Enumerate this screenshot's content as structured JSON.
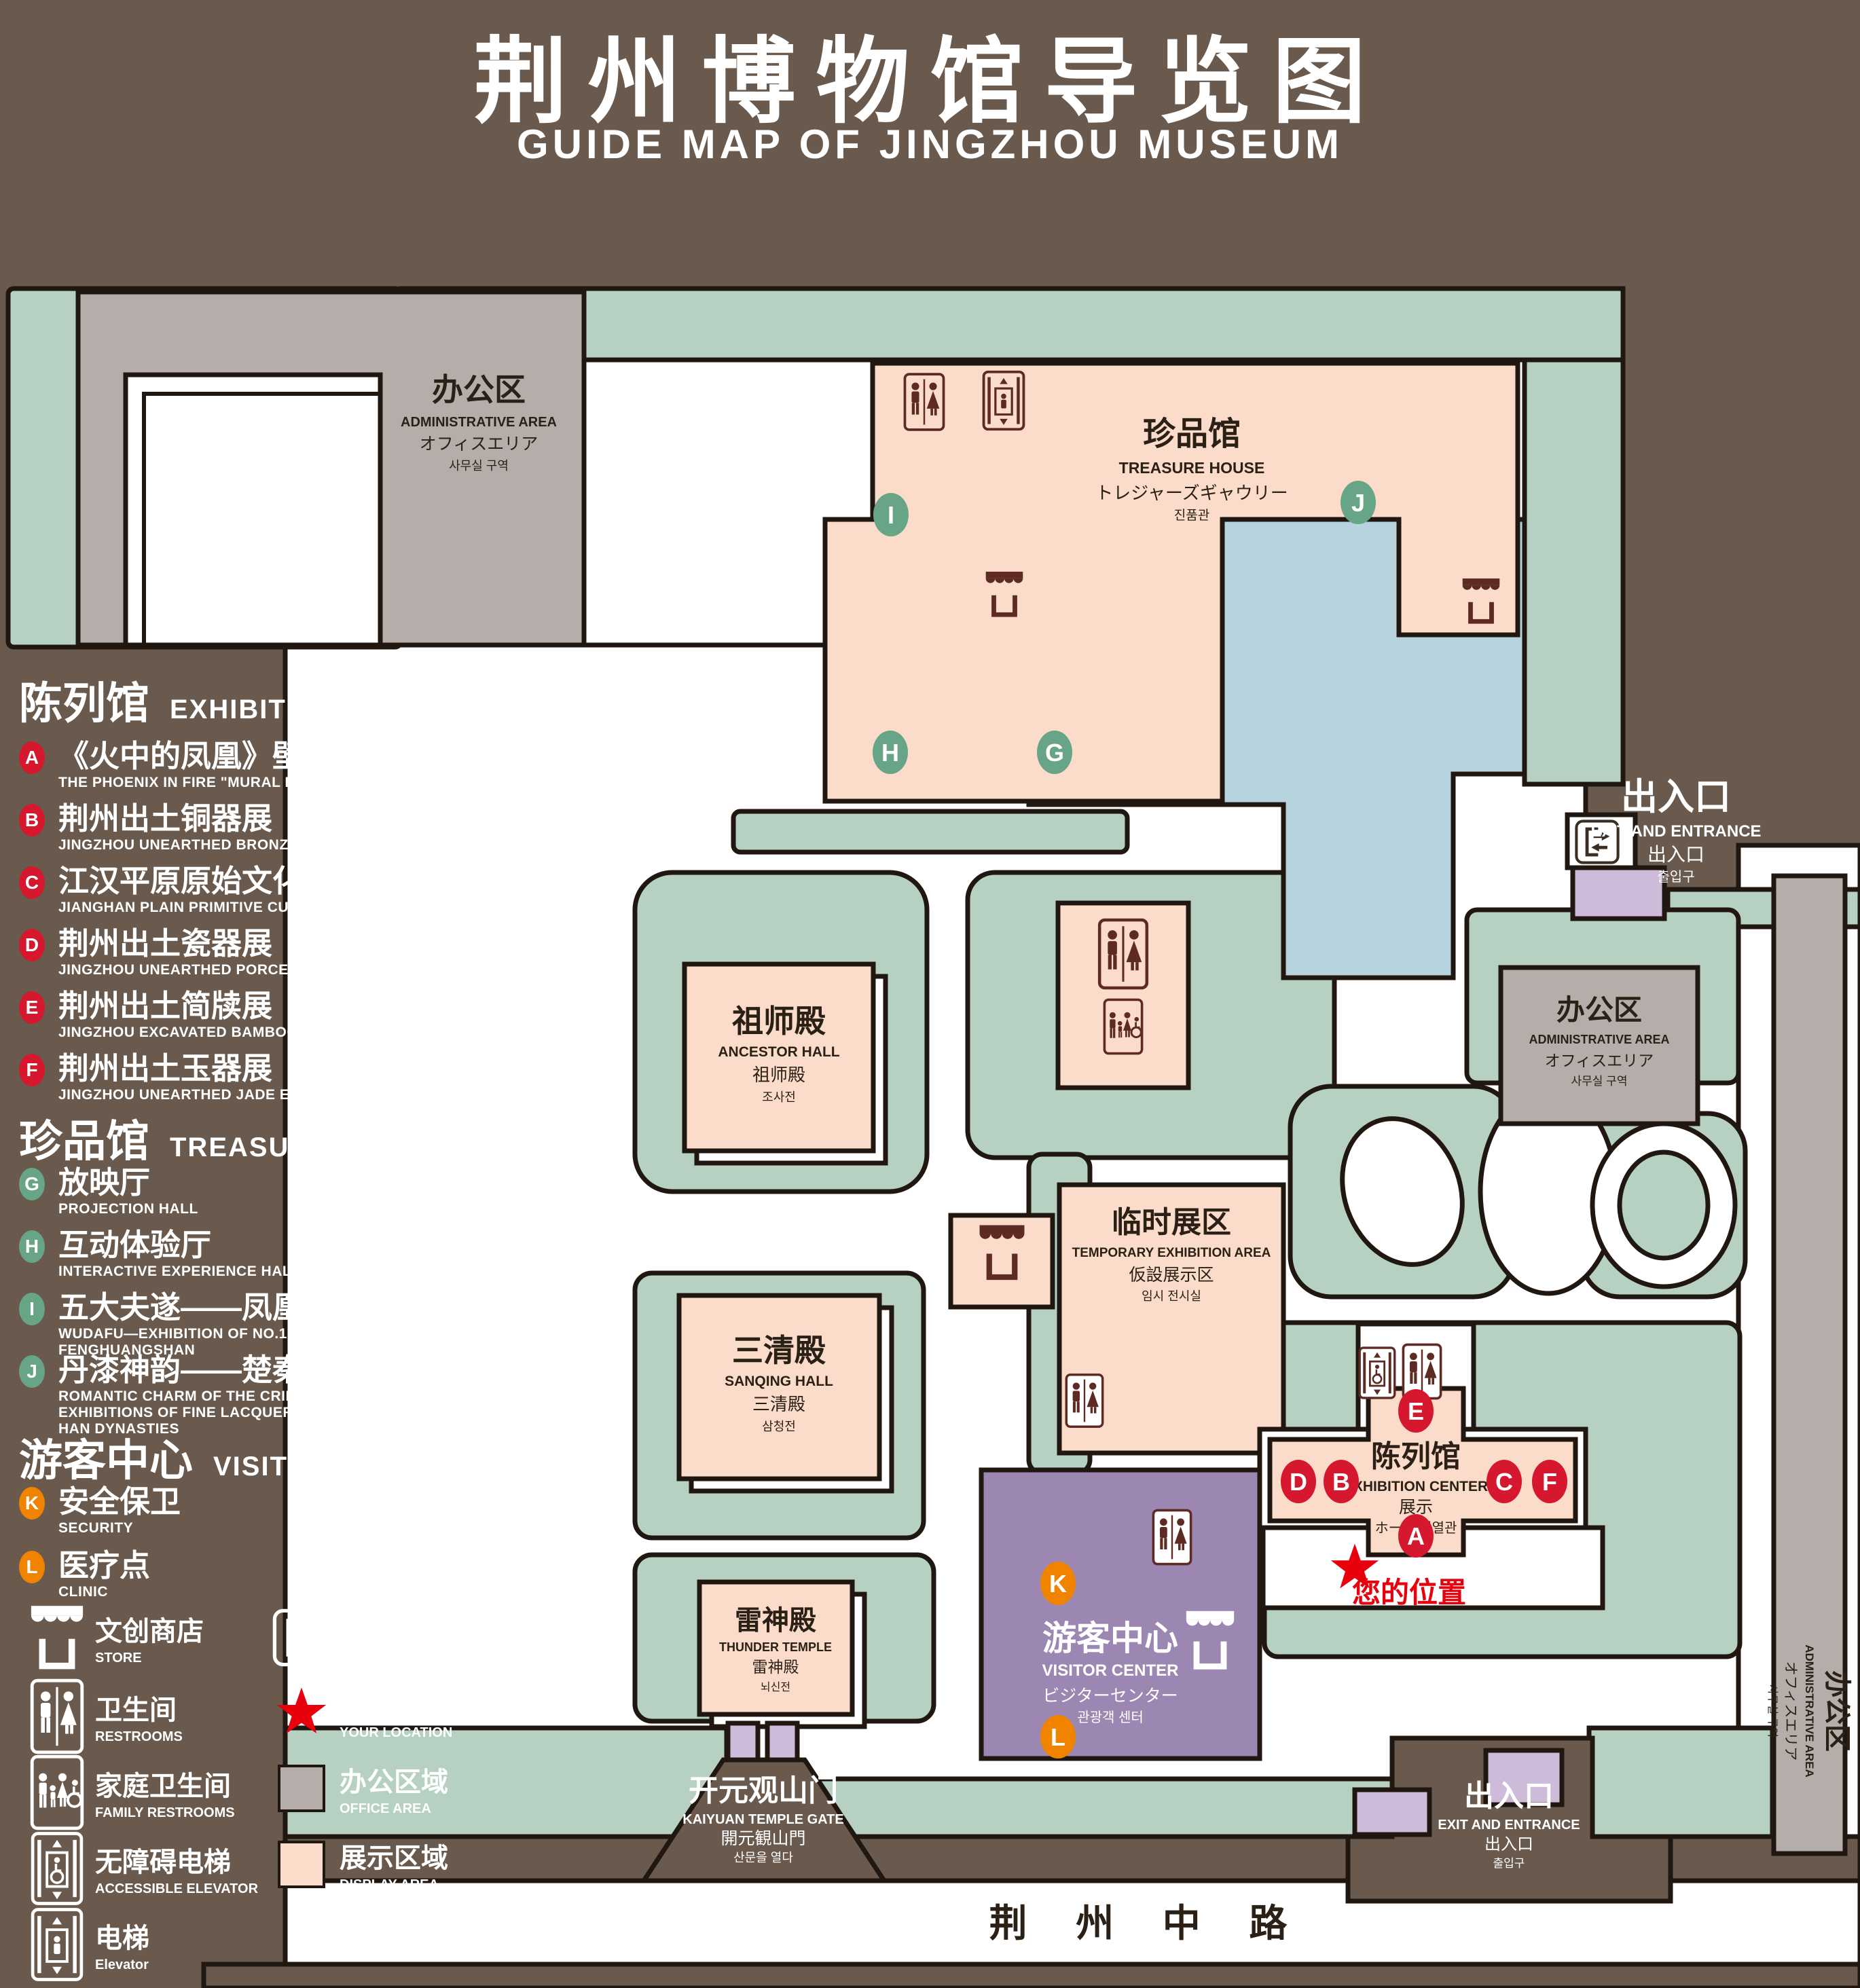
{
  "title": {
    "zh": "荆州博物馆导览图",
    "en": "GUIDE MAP OF JINGZHOU MUSEUM"
  },
  "colors": {
    "background": "#6a594d",
    "green_area": "#b6d0c2",
    "display_area": "#fbdcca",
    "office_area": "#b4adaa",
    "pond": "#b7d3de",
    "visitor_center": "#9c86b2",
    "small_building": "#cdbbd9",
    "marker_red": "#d5182e",
    "marker_green": "#68a586",
    "marker_orange": "#f08300",
    "location_red": "#e8000d",
    "icon_dark": "#5d2b23",
    "outline": "#201711"
  },
  "legend": {
    "sections": [
      {
        "zh": "陈列馆",
        "en": "EXHIBITION CENTER",
        "items": [
          {
            "id": "A",
            "zh": "《火中的凤凰》壁画",
            "en": "THE PHOENIX IN FIRE \"MURAL PAINTING",
            "floor": "1F"
          },
          {
            "id": "B",
            "zh": "荆州出土铜器展",
            "en": "JINGZHOU UNEARTHED BRONZE WARE EXHIBITION",
            "floor": "1F"
          },
          {
            "id": "C",
            "zh": "江汉平原原始文化展",
            "en": "JIANGHAN PLAIN PRIMITIVE CULTURE EXHIBITION",
            "floor": "1F"
          },
          {
            "id": "D",
            "zh": "荆州出土瓷器展",
            "en": "JINGZHOU UNEARTHED PORCELAIN EXHIBITIONE",
            "floor": "2F"
          },
          {
            "id": "E",
            "zh": "荆州出土简牍展",
            "en": "JINGZHOU EXCAVATED BAMBOO SLIPS EXHIBITION",
            "floor": "2F"
          },
          {
            "id": "F",
            "zh": "荆州出土玉器展",
            "en": "JINGZHOU UNEARTHED JADE EXHIBITION",
            "floor": "2F"
          }
        ]
      },
      {
        "zh": "珍品馆",
        "en": "TREASURE HOUSE",
        "items": [
          {
            "id": "G",
            "zh": "放映厅",
            "en": "PROJECTION HALL",
            "floor": "1F"
          },
          {
            "id": "H",
            "zh": "互动体验厅",
            "en": "INTERACTIVE EXPERIENCE HALL",
            "floor": "1F"
          },
          {
            "id": "I",
            "zh": "五大夫遂——凤凰山168号汉墓展",
            "en": "WUDAFU—EXHIBITION OF NO.168 HAN TOMB FROM FENGHUANGSHAN",
            "floor": "2F"
          },
          {
            "id": "J",
            "zh": "丹漆神韵——楚秦汉漆器精品展",
            "en": "ROMANTIC CHARM OF THE CRIMSON LACQUERS—EXHIBITIONS OF FINE LACQUERS FROM CHU,QIN AND HAN DYNASTIES",
            "floor": "1-2F"
          }
        ]
      },
      {
        "zh": "游客中心",
        "en": "VISITOR CENTER",
        "items": [
          {
            "id": "K",
            "zh": "安全保卫",
            "en": "SECURITY",
            "floor": "1F"
          },
          {
            "id": "L",
            "zh": "医疗点",
            "en": "CLINIC",
            "floor": "1F"
          }
        ]
      }
    ],
    "symbols": [
      {
        "icon": "store-icon",
        "zh": "文创商店",
        "en": "STORE"
      },
      {
        "icon": "exit-icon",
        "zh": "出入口",
        "en": "EXIT AND ENTRANCE"
      },
      {
        "icon": "restrooms-icon",
        "zh": "卫生间",
        "en": "RESTROOMS"
      },
      {
        "icon": "your-location-icon",
        "zh": "您的位置",
        "en": "YOUR LOCATION"
      },
      {
        "icon": "family-restrooms-icon",
        "zh": "家庭卫生间",
        "en": "FAMILY RESTROOMS"
      },
      {
        "icon": "office-area-swatch",
        "zh": "办公区域",
        "en": "OFFICE AREA"
      },
      {
        "icon": "accessible-elevator-icon",
        "zh": "无障碍电梯",
        "en": "ACCESSIBLE ELEVATOR"
      },
      {
        "icon": "display-area-swatch",
        "zh": "展示区域",
        "en": "DISPLAY AREA"
      },
      {
        "icon": "elevator-icon",
        "zh": "电梯",
        "en": "Elevator"
      }
    ]
  },
  "map": {
    "buildings": {
      "admin": {
        "lines": [
          "办公区",
          "ADMINISTRATIVE AREA",
          "オフィスエリア",
          "사무실 구역"
        ]
      },
      "treasure": {
        "lines": [
          "珍品馆",
          "TREASURE HOUSE",
          "トレジャーズギャウリー",
          "진품관"
        ]
      },
      "ancestor": {
        "lines": [
          "祖师殿",
          "ANCESTOR HALL",
          "祖师殿",
          "조사전"
        ]
      },
      "temp": {
        "lines": [
          "临时展区",
          "TEMPORARY EXHIBITION AREA",
          "仮設展示区",
          "임시 전시실"
        ]
      },
      "sanqing": {
        "lines": [
          "三清殿",
          "SANQING HALL",
          "三清殿",
          "삼청전"
        ]
      },
      "thunder": {
        "lines": [
          "雷神殿",
          "THUNDER TEMPLE",
          "雷神殿",
          "뇌신전"
        ]
      },
      "visitor": {
        "lines": [
          "游客中心",
          "VISITOR CENTER",
          "ビジターセンター",
          "관광객 센터"
        ]
      },
      "exhibition": {
        "lines": [
          "陈列馆",
          "EXHIBITION CENTER",
          "展示",
          "ホール 진열관"
        ]
      },
      "gate": {
        "lines": [
          "开元观山门",
          "KAIYUAN TEMPLE GATE",
          "開元観山門",
          "산문을 열다"
        ]
      },
      "exit": {
        "lines": [
          "出入口",
          "EXIT AND ENTRANCE",
          "出入口",
          "출입구"
        ]
      }
    },
    "markers": [
      "A",
      "B",
      "C",
      "D",
      "E",
      "F",
      "G",
      "H",
      "I",
      "J",
      "K",
      "L"
    ],
    "your_location": "您的位置",
    "road": "荆 州 中 路"
  }
}
